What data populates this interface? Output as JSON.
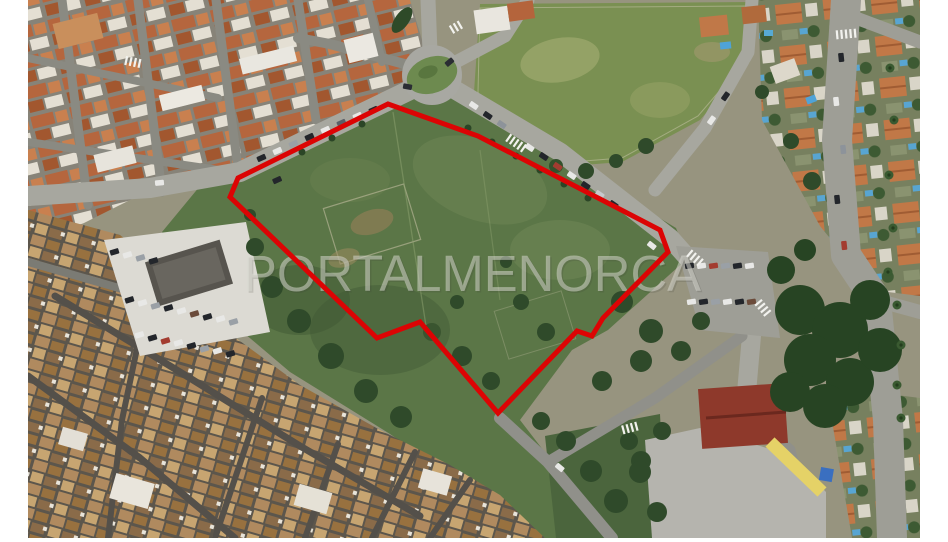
{
  "watermark": {
    "text": "PORTALMENORCA",
    "color": "#dadad2"
  },
  "boundary": {
    "points": "388,104 478,136 660,230 668,252 603,318 592,336 577,331 498,413 420,322 377,338 230,197 238,178",
    "color": "#dc0404"
  },
  "scene": {
    "description_colors": {
      "street_gray": "#a7a79f",
      "plot_green": "#5b7647",
      "field_green": "#7a9052",
      "roof_terracotta": "#b5663e",
      "oldtown_roof": "#b08a5f",
      "school_roof": "#8e392b",
      "yard_gray": "#b5b4ae",
      "pool_blue": "#4fa3d8"
    }
  }
}
